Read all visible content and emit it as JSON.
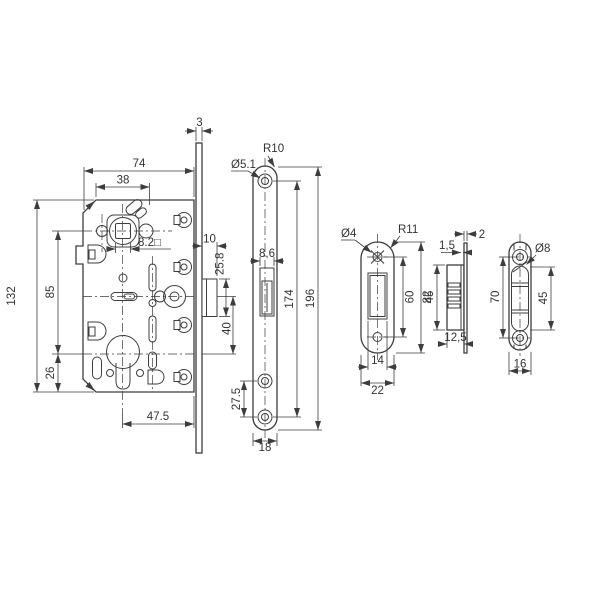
{
  "drawing": {
    "title": "mortise-magnetic-lock-technical-drawing",
    "colors": {
      "line": "#3d3d3d",
      "text": "#333333",
      "background": "#ffffff"
    },
    "lock_body": {
      "width": "74",
      "inner_width": "38",
      "height": "132",
      "spindle_to_cylinder": "85",
      "cylinder_to_bottom": "26",
      "cylinder_backset": "47.5",
      "spindle_square": "8.2□"
    },
    "faceplate_side": {
      "plate_thickness": "3",
      "latch_depth": "10",
      "latch_height": "25.8",
      "latch_to_cylinder": "40"
    },
    "faceplate_front": {
      "hole_diameter": "Ø5.1",
      "corner_radius": "R10",
      "opening_width": "8,6",
      "hole_spacing": "174",
      "length": "196",
      "bottom_hole_spacing": "27.5",
      "width": "18"
    },
    "strike_plate": {
      "hole_diameter": "Ø4",
      "corner_radius": "R11",
      "hole_spacing": "60",
      "length": "82",
      "opening_width": "14",
      "width": "22"
    },
    "strike_box_side": {
      "plate_thickness": "2",
      "wall_thickness": "1,5",
      "box_height": "45",
      "box_depth": "12,5"
    },
    "round_strike": {
      "recess_diameter": "Ø8",
      "hole_spacing": "70",
      "opening_height": "45",
      "width": "16"
    }
  }
}
